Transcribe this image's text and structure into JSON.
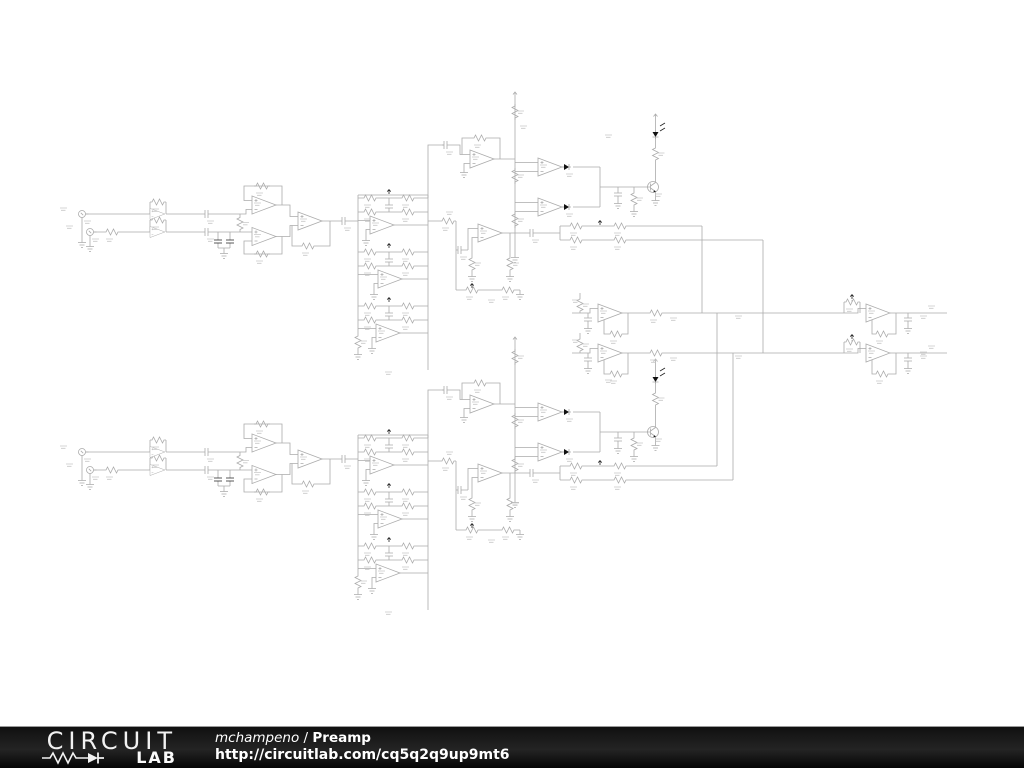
{
  "footer": {
    "logo_line1": "CIRCUIT",
    "logo_line2": "LAB",
    "author": "mchampeno",
    "separator": " / ",
    "title": "Preamp",
    "url": "http://circuitlab.com/cq5q2q9up9mt6"
  },
  "schematic": {
    "line_color": "#ababab",
    "label_color": "#c9c9c9",
    "component_black": "#222222",
    "background": "#ffffff"
  }
}
